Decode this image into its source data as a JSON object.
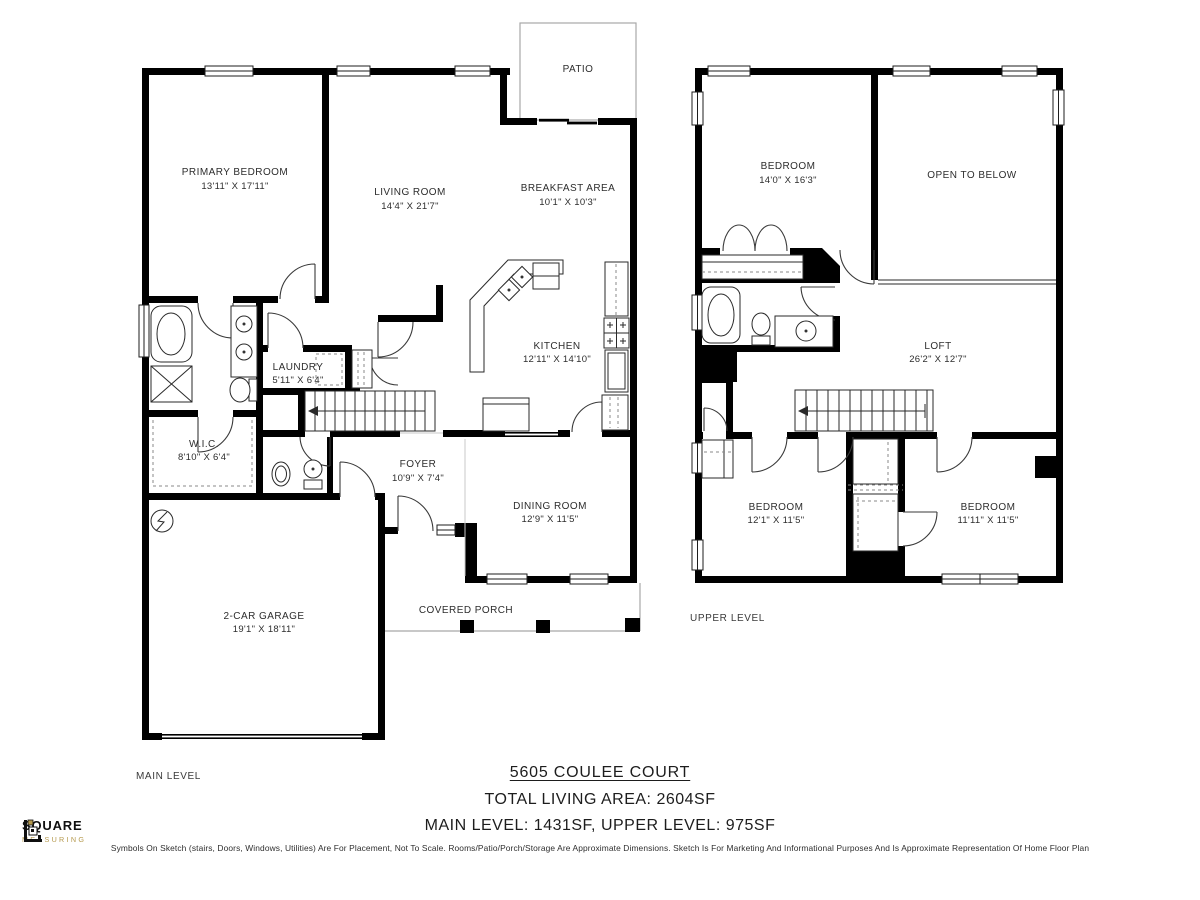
{
  "colors": {
    "wall": "#000000",
    "logo_gold": "#b5994d"
  },
  "main_level": {
    "label": "MAIN LEVEL",
    "rooms": {
      "primary_bedroom": {
        "name": "PRIMARY BEDROOM",
        "dims": "13'11\" X 17'11\""
      },
      "living_room": {
        "name": "LIVING ROOM",
        "dims": "14'4\" X 21'7\""
      },
      "patio": {
        "name": "PATIO"
      },
      "breakfast": {
        "name": "BREAKFAST AREA",
        "dims": "10'1\" X 10'3\""
      },
      "kitchen": {
        "name": "KITCHEN",
        "dims": "12'11\" X 14'10\""
      },
      "laundry": {
        "name": "LAUNDRY",
        "dims": "5'11\" X 6'4\""
      },
      "wic": {
        "name": "W.I.C.",
        "dims": "8'10\" X 6'4\""
      },
      "foyer": {
        "name": "FOYER",
        "dims": "10'9\" X 7'4\""
      },
      "dining": {
        "name": "DINING ROOM",
        "dims": "12'9\" X 11'5\""
      },
      "garage": {
        "name": "2-CAR GARAGE",
        "dims": "19'1\" X 18'11\""
      },
      "porch": {
        "name": "COVERED PORCH"
      }
    }
  },
  "upper_level": {
    "label": "UPPER LEVEL",
    "rooms": {
      "bedroom1": {
        "name": "BEDROOM",
        "dims": "14'0\" X 16'3\""
      },
      "open_below": {
        "name": "OPEN TO BELOW"
      },
      "loft": {
        "name": "LOFT",
        "dims": "26'2\" X 12'7\""
      },
      "bedroom2": {
        "name": "BEDROOM",
        "dims": "12'1\" X 11'5\""
      },
      "bedroom3": {
        "name": "BEDROOM",
        "dims": "11'11\" X 11'5\""
      }
    }
  },
  "footer": {
    "address": "5605 COULEE COURT",
    "total": "TOTAL LIVING AREA: 2604SF",
    "levels": "MAIN LEVEL: 1431SF, UPPER LEVEL: 975SF",
    "disclaimer": "Symbols On Sketch (stairs, Doors, Windows, Utilities) Are For Placement, Not To Scale. Rooms/Patio/Porch/Storage Are Approximate Dimensions. Sketch Is For Marketing And Informational Purposes And Is Approximate Representation Of Home Floor Plan"
  },
  "logo": {
    "line1": "SQUARE",
    "line2": "MEASURING"
  }
}
